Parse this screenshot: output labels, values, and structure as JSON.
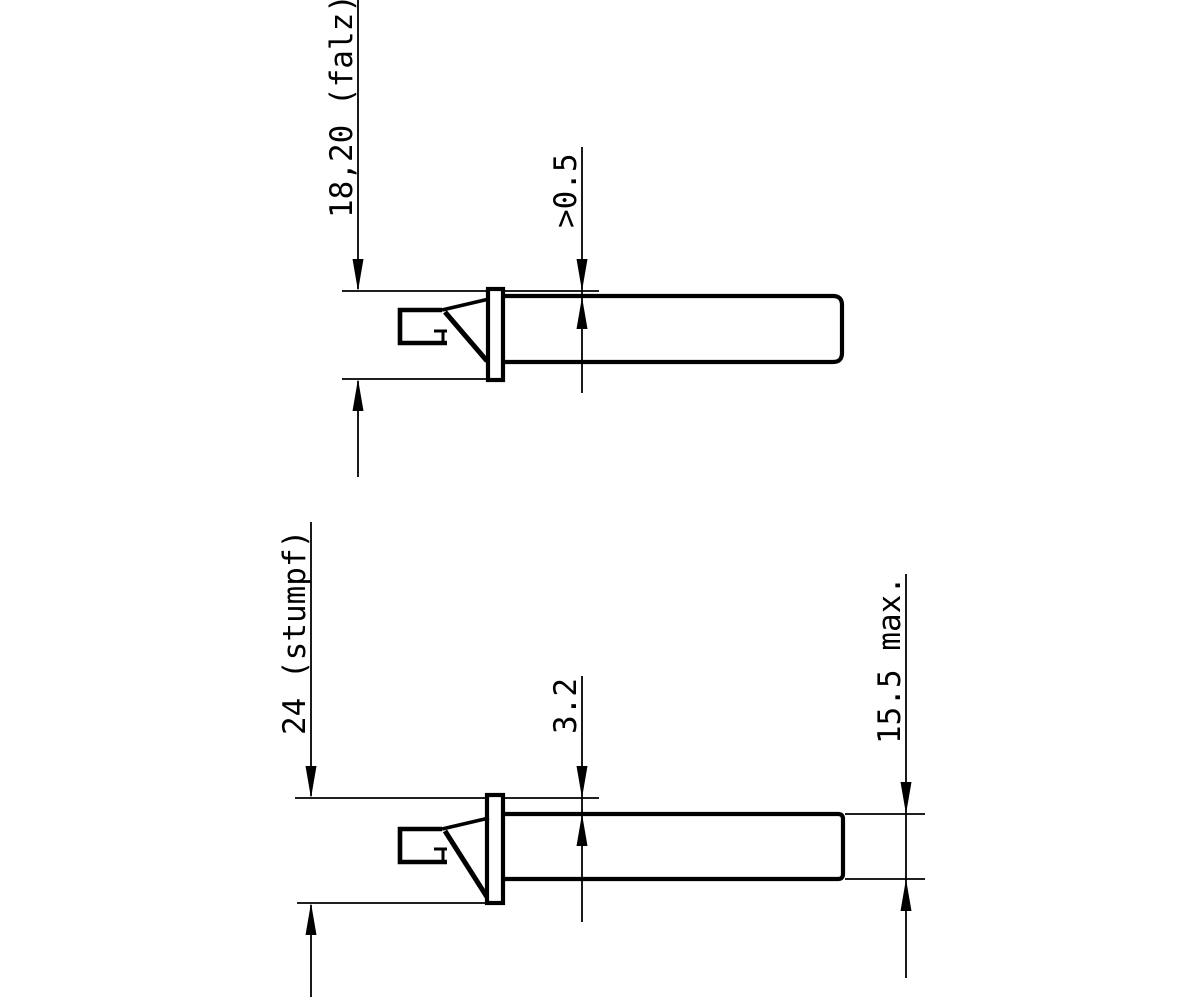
{
  "palette": {
    "background": "#ffffff",
    "ink": "#000000"
  },
  "figures": [
    {
      "dimensions": [
        {
          "id": "height-falz",
          "label": "18,20 (falz)"
        },
        {
          "id": "faceplate-protrusion",
          "label": ">0.5"
        }
      ]
    },
    {
      "dimensions": [
        {
          "id": "height-stumpf",
          "label": "24 (stumpf)"
        },
        {
          "id": "faceplate-protrusion",
          "label": "3.2"
        },
        {
          "id": "case-height-max",
          "label": "15.5 max."
        }
      ]
    }
  ]
}
